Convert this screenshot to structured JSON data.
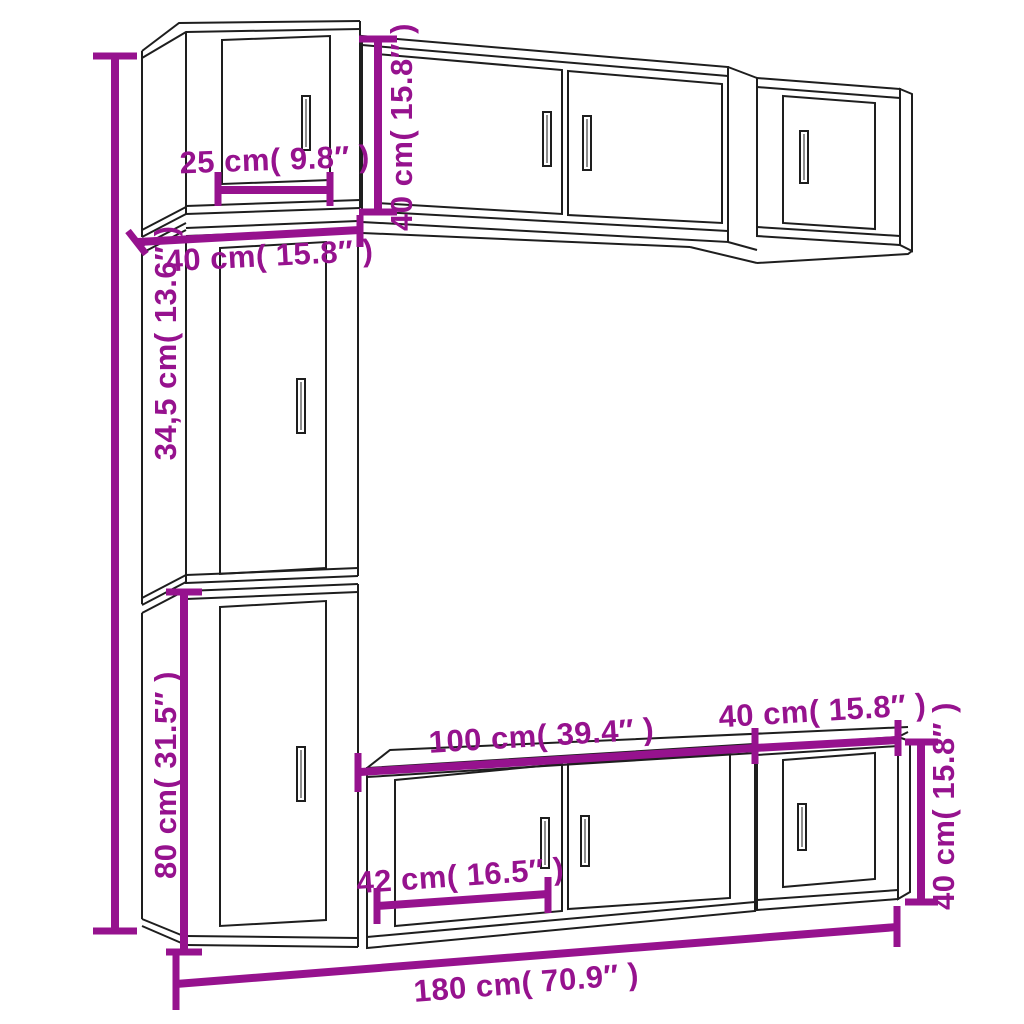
{
  "diagram": {
    "kind": "furniture-dimension-diagram",
    "subject": "wall-mounted TV cabinet set (7 pieces)",
    "colors": {
      "dimension_accent": "#96128E",
      "outline": "#1e1e1e",
      "background": "#ffffff"
    },
    "dimensions": {
      "top_left_cabinet_width": "25 cm( 9.8″ )",
      "top_row_height": "40 cm( 15.8″ )",
      "left_column_width": "40 cm( 15.8″ )",
      "middle_cabinet_height": "34,5 cm( 13.6″ )",
      "bottom_left_cabinet_height": "80 cm( 31.5″ )",
      "bottom_wide_cabinet_width": "100 cm( 39.4″ )",
      "bottom_small_cabinet_width": "40 cm( 15.8″ )",
      "bottom_cabinet_door_width": "42 cm( 16.5″ )",
      "bottom_row_height": "40 cm( 15.8″ )",
      "overall_width": "180 cm( 70.9″ )"
    }
  }
}
